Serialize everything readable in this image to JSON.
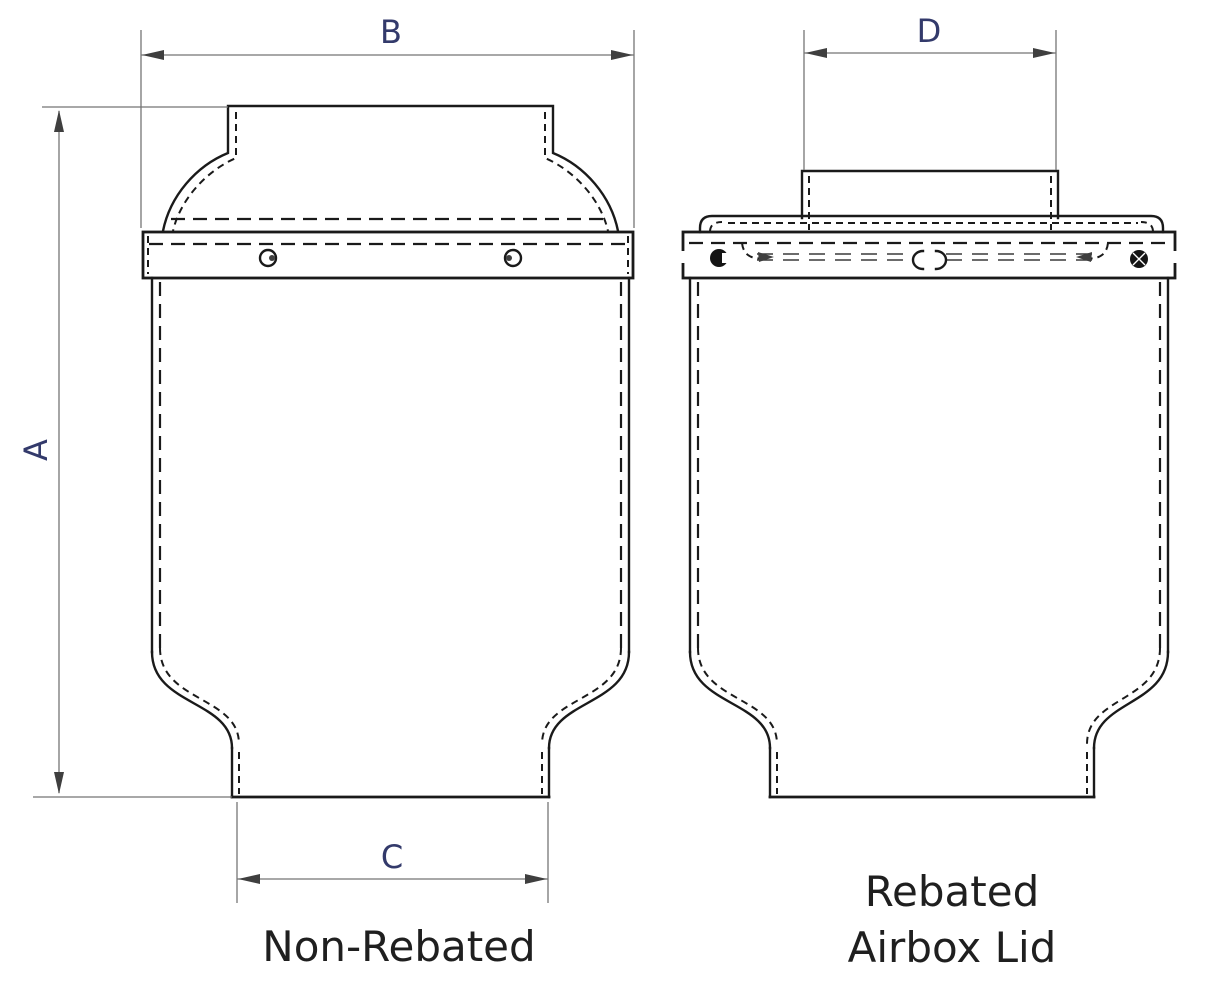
{
  "drawing": {
    "dim_labels": {
      "a": "A",
      "b": "B",
      "c": "C",
      "d": "D"
    },
    "captions": {
      "left_view": "Non-Rebated",
      "right_view_line1": "Rebated",
      "right_view_line2": "Airbox Lid"
    },
    "colors": {
      "dimension_label": "#333a6b",
      "caption_text": "#1f1f1f",
      "object_line": "#1a1a1a",
      "dimension_line": "#757575",
      "background": "#ffffff"
    }
  }
}
